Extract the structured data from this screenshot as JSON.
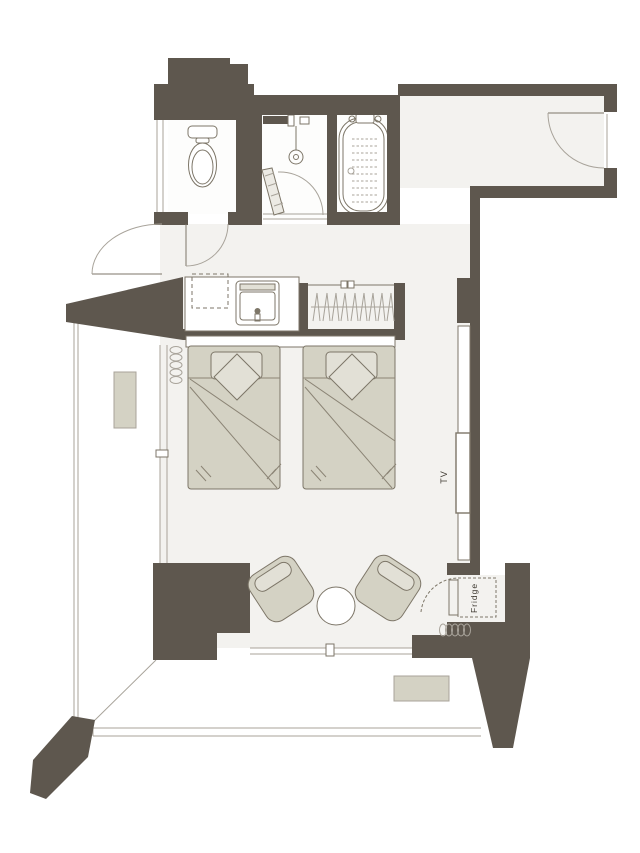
{
  "plan": {
    "labels": {
      "tv": "TV",
      "fridge": "Fridge"
    },
    "colors": {
      "bg": "#ffffff",
      "wall": "#5e574e",
      "floor": "#f3f2ef",
      "room_white": "#fdfdfc",
      "furniture": "#d4d2c4",
      "furniture_light": "#e2e0d6",
      "line": "#7d7668",
      "line_light": "#a8a39a",
      "fold": "#8b8475",
      "text": "#3c372f"
    },
    "icons": [
      "toilet-icon",
      "shower-icon",
      "bathtub-icon",
      "sink-icon",
      "hanger-icon",
      "bed-icon",
      "pillow-icon",
      "cushion-icon",
      "armchair-icon",
      "coffee-table-icon",
      "fridge-icon",
      "tv-board-icon",
      "curtain-coil-icon",
      "ac-unit-icon",
      "door-swing-icon"
    ]
  }
}
